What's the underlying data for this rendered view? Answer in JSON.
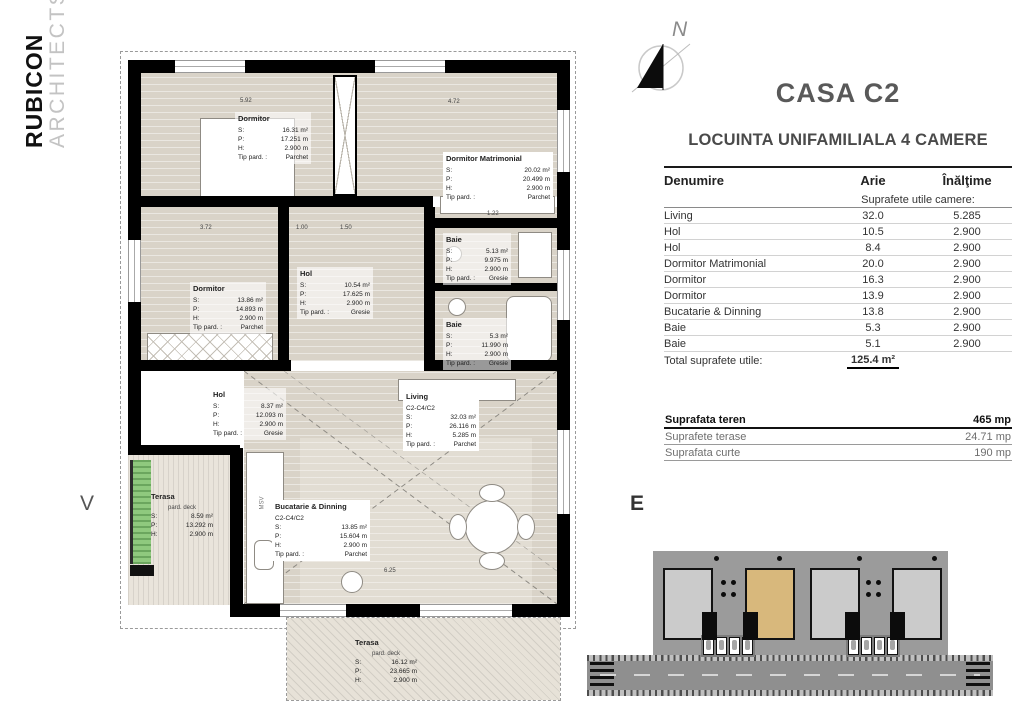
{
  "branding": {
    "line1": "RUBICON",
    "line2": "ARCHITECTS"
  },
  "compass": {
    "north_label": "N"
  },
  "orientation": {
    "west_label": "V",
    "east_label": "E"
  },
  "header": {
    "title": "CASA C2",
    "subtitle": "LOCUINTA UNIFAMILIALA 4 CAMERE"
  },
  "table": {
    "columns": {
      "name": "Denumire",
      "area": "Arie",
      "height": "Înălţime"
    },
    "section_label": "Suprafete utile camere:",
    "rows": [
      {
        "name": "Living",
        "arie": "32.0",
        "inaltime": "5.285"
      },
      {
        "name": "Hol",
        "arie": "10.5",
        "inaltime": "2.900"
      },
      {
        "name": "Hol",
        "arie": "8.4",
        "inaltime": "2.900"
      },
      {
        "name": "Dormitor Matrimonial",
        "arie": "20.0",
        "inaltime": "2.900"
      },
      {
        "name": "Dormitor",
        "arie": "16.3",
        "inaltime": "2.900"
      },
      {
        "name": "Dormitor",
        "arie": "13.9",
        "inaltime": "2.900"
      },
      {
        "name": "Bucatarie & Dinning",
        "arie": "13.8",
        "inaltime": "2.900"
      },
      {
        "name": "Baie",
        "arie": "5.3",
        "inaltime": "2.900"
      },
      {
        "name": "Baie",
        "arie": "5.1",
        "inaltime": "2.900"
      }
    ],
    "total_label": "Total suprafete utile:",
    "total_value": "125.4 m²"
  },
  "land": {
    "rows": [
      {
        "label": "Suprafata teren",
        "value": "465 mp"
      },
      {
        "label": "Suprafete terase",
        "value": "24.71 mp"
      },
      {
        "label": "Suprafata curte",
        "value": "190 mp"
      }
    ]
  },
  "floorplan": {
    "legend": {
      "s": "S:",
      "p": "P:",
      "h": "H:",
      "tip": "Tip pard. :"
    },
    "kitchen_text": "MSV",
    "rooms": [
      {
        "title": "Dormitor",
        "s": "16.31 m²",
        "p": "17.251 m",
        "h": "2.900 m",
        "tip": "Parchet"
      },
      {
        "title": "Dormitor Matrimonial",
        "s": "20.02 m²",
        "p": "20.499 m",
        "h": "2.900 m",
        "tip": "Parchet"
      },
      {
        "title": "Dormitor",
        "s": "13.86 m²",
        "p": "14.893 m",
        "h": "2.900 m",
        "tip": "Parchet"
      },
      {
        "title": "Hol",
        "s": "10.54 m²",
        "p": "17.625 m",
        "h": "2.900 m",
        "tip": "Gresie"
      },
      {
        "title": "Baie",
        "s": "5.13 m²",
        "p": "9.975 m",
        "h": "2.900 m",
        "tip": "Gresie"
      },
      {
        "title": "Baie",
        "s": "5.3 m²",
        "p": "11.990 m",
        "h": "2.900 m",
        "tip": "Gresie"
      },
      {
        "title": "Hol",
        "s": "8.37 m²",
        "p": "12.093 m",
        "h": "2.900 m",
        "tip": "Gresie"
      },
      {
        "title": "Living",
        "code": "C2-C4/C2",
        "s": "32.03 m²",
        "p": "26.116 m",
        "h": "5.285 m",
        "tip": "Parchet"
      },
      {
        "title": "Bucatarie & Dinning",
        "code": "C2-C4/C2",
        "s": "13.85 m²",
        "p": "15.604 m",
        "h": "2.900 m",
        "tip": "Parchet"
      },
      {
        "title": "Terasa",
        "sub": "pard. deck",
        "s": "8.59 m²",
        "p": "13.292 m",
        "h": "2.900 m"
      },
      {
        "title": "Terasa",
        "sub": "pard. deck",
        "s": "16.12 m²",
        "p": "23.665 m",
        "h": "2.900 m"
      }
    ],
    "dims": [
      "5.92",
      "4.72",
      "3.72",
      "1.00",
      "1.50",
      "6.25",
      "1.22"
    ]
  }
}
